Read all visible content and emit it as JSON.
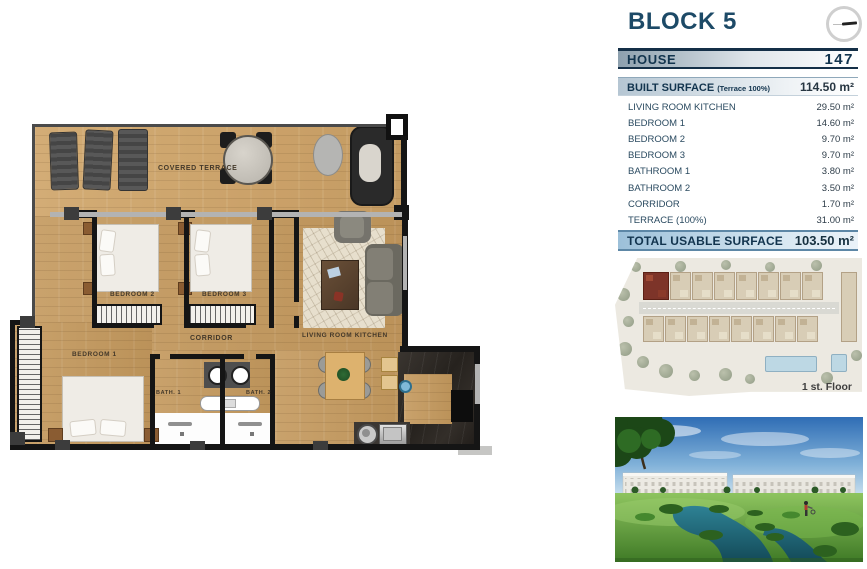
{
  "header": {
    "block_title": "BLOCK 5"
  },
  "table": {
    "house_label": "HOUSE",
    "house_number": "147",
    "built_surface_label": "BUILT SURFACE",
    "built_surface_note": "(Terrace 100%)",
    "built_surface_value": "114.50 m²",
    "rooms": [
      {
        "label": "LIVING ROOM KITCHEN",
        "value": "29.50 m²"
      },
      {
        "label": "BEDROOM 1",
        "value": "14.60 m²"
      },
      {
        "label": "BEDROOM 2",
        "value": "9.70 m²"
      },
      {
        "label": "BEDROOM 3",
        "value": "9.70 m²"
      },
      {
        "label": "BATHROOM 1",
        "value": "3.80 m²"
      },
      {
        "label": "BATHROOM 2",
        "value": "3.50 m²"
      },
      {
        "label": "CORRIDOR",
        "value": "1.70 m²"
      },
      {
        "label": "TERRACE (100%)",
        "value": "31.00 m²"
      }
    ],
    "total_label": "TOTAL USABLE SURFACE",
    "total_value": "103.50 m²"
  },
  "floorplan": {
    "labels": {
      "terrace": "COVERED TERRACE",
      "bedroom2": "BEDROOM 2",
      "bedroom3": "BEDROOM 3",
      "corridor": "CORRIDOR",
      "bedroom1": "BEDROOM 1",
      "bath1": "BATH. 1",
      "bath2": "BATH. 2",
      "living": "LIVING ROOM KITCHEN"
    }
  },
  "siteplan": {
    "floor_label": "1 st. Floor",
    "highlight_color": "#7d3429"
  },
  "colors": {
    "accent_navy": "#1d4a67",
    "wood": "#c49d66",
    "site_highlight": "#7d3429",
    "water": "#1f6273"
  }
}
